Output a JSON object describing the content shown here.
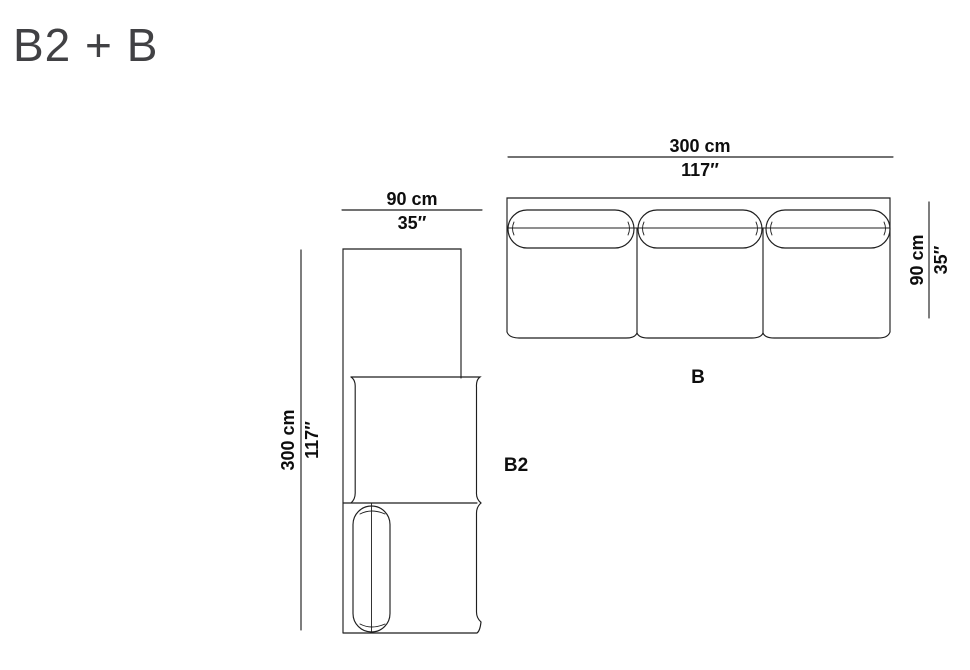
{
  "title": "B2 + B",
  "modules": {
    "b2": {
      "label": "B2",
      "width_cm": "90 cm",
      "width_in": "35″",
      "length_cm": "300 cm",
      "length_in": "117″"
    },
    "b": {
      "label": "B",
      "width_cm": "300 cm",
      "width_in": "117″",
      "depth_cm": "90 cm",
      "depth_in": "35″"
    }
  },
  "colors": {
    "line": "#1f1f1f",
    "dimension_text": "#0e0e0e",
    "title_text": "#414144",
    "background": "#ffffff"
  }
}
